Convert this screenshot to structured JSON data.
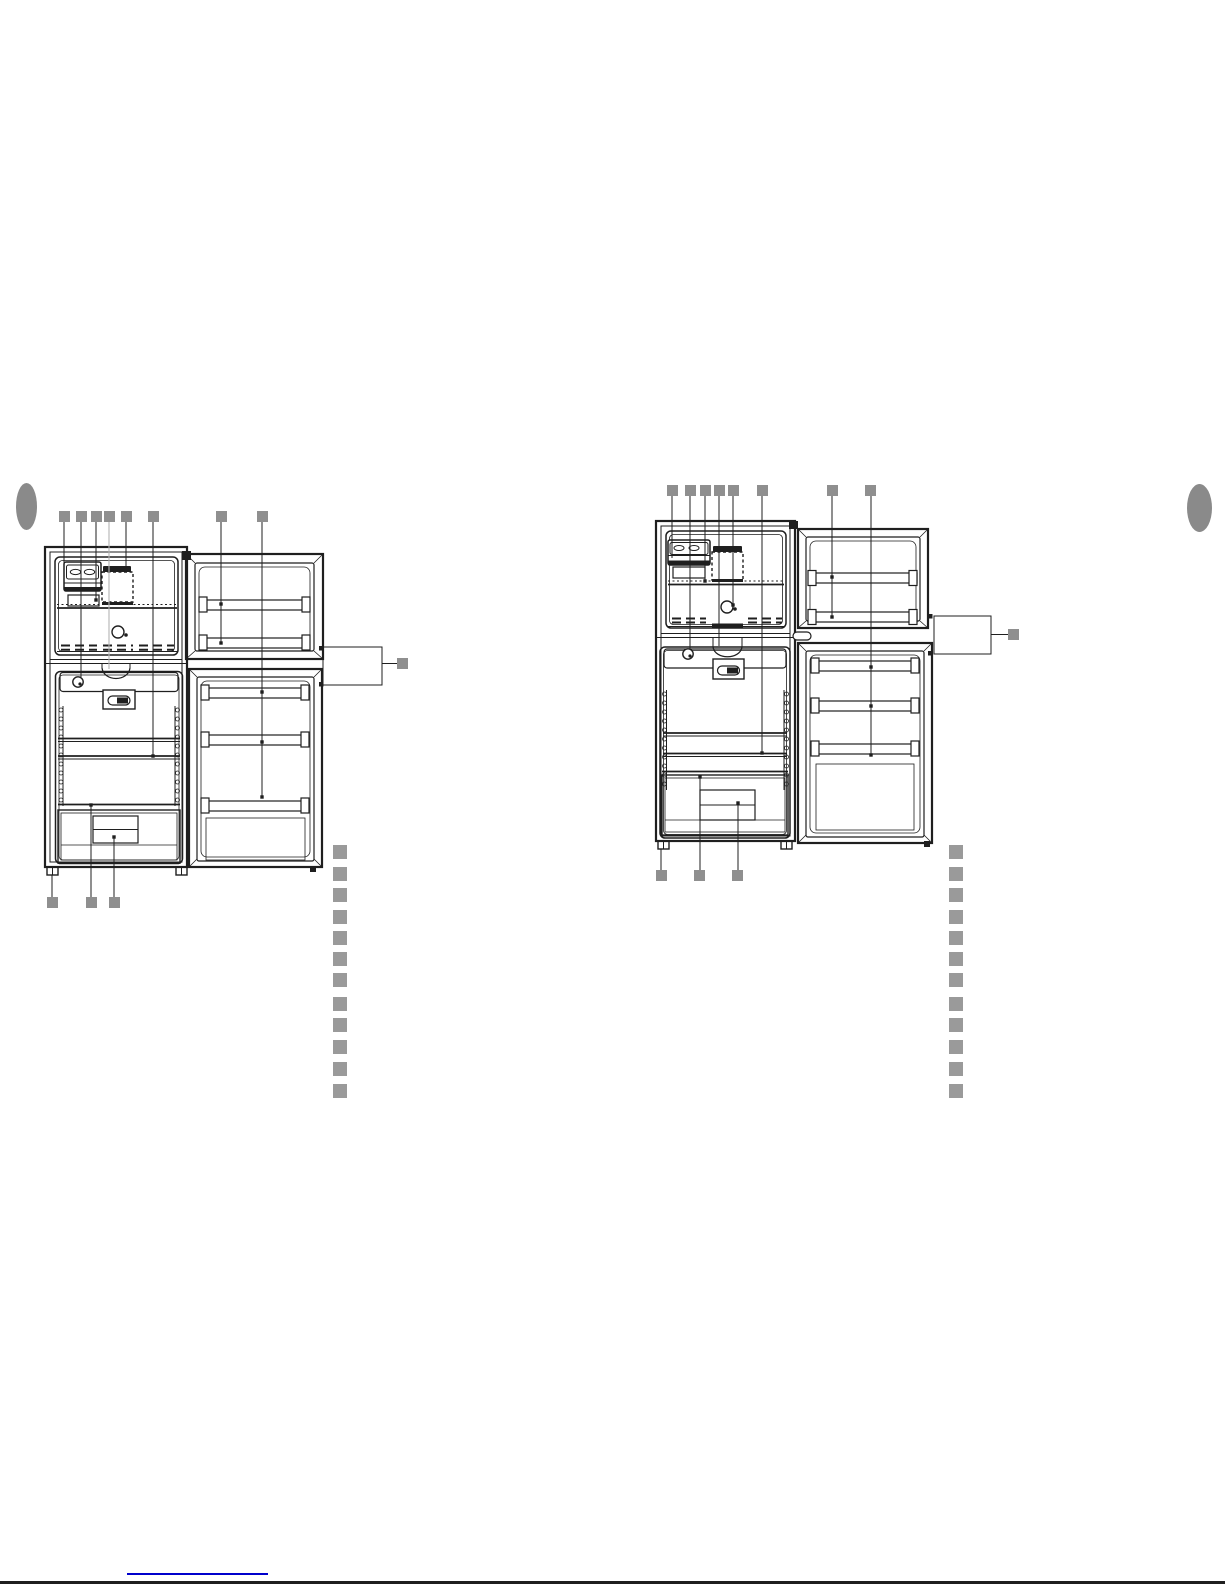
{
  "page": {
    "width": 1225,
    "height": 1585,
    "background": "#ffffff",
    "line_color": "#1f1f1f",
    "light_leader_color": "#b3b3b3",
    "callout_marker_color": "#8f8f8f",
    "caption_placeholder_color": "#9a9a9a",
    "side_oval_color": "#8a8a8a",
    "footer_link_color": "#0000cc",
    "footer_rule_color": "#000000"
  },
  "figures": [
    {
      "name": "refrigerator-diagram-left",
      "callout_size": 11,
      "top_callouts": [
        {
          "x": 59,
          "y": 511
        },
        {
          "x": 76,
          "y": 511
        },
        {
          "x": 91,
          "y": 511
        },
        {
          "x": 104,
          "y": 511
        },
        {
          "x": 121,
          "y": 511
        },
        {
          "x": 148,
          "y": 511
        },
        {
          "x": 216,
          "y": 511
        },
        {
          "x": 257,
          "y": 511
        }
      ],
      "bottom_callouts": [
        {
          "x": 47,
          "y": 897
        },
        {
          "x": 86,
          "y": 897
        },
        {
          "x": 109,
          "y": 897
        }
      ],
      "side_callout": {
        "x": 397,
        "y": 658
      }
    },
    {
      "name": "refrigerator-diagram-right",
      "callout_size": 11,
      "top_callouts": [
        {
          "x": 667,
          "y": 485
        },
        {
          "x": 685,
          "y": 485
        },
        {
          "x": 700,
          "y": 485
        },
        {
          "x": 714,
          "y": 485
        },
        {
          "x": 728,
          "y": 485
        },
        {
          "x": 757,
          "y": 485
        },
        {
          "x": 827,
          "y": 485
        },
        {
          "x": 865,
          "y": 485
        }
      ],
      "bottom_callouts": [
        {
          "x": 656,
          "y": 870
        },
        {
          "x": 694,
          "y": 870
        },
        {
          "x": 732,
          "y": 870
        }
      ],
      "side_callout": {
        "x": 1008,
        "y": 629
      }
    }
  ],
  "caption_placeholders": {
    "square_size": 14,
    "left_column": {
      "x": 333,
      "ys": [
        845,
        867,
        888,
        910,
        931,
        952,
        973,
        997,
        1018,
        1040,
        1062,
        1084
      ]
    },
    "right_column": {
      "x": 949,
      "ys": [
        845,
        867,
        888,
        910,
        931,
        952,
        973,
        997,
        1018,
        1040,
        1062,
        1084
      ]
    }
  },
  "page_side_ovals": {
    "left": {
      "x": 16,
      "y": 483,
      "w": 21,
      "h": 47
    },
    "right": {
      "x": 1187,
      "y": 484,
      "w": 25,
      "h": 48
    }
  },
  "footer": {
    "link_underline": {
      "x": 127,
      "y": 1573,
      "w": 141,
      "h": 2
    },
    "bottom_rule": {
      "x": 0,
      "y": 1581,
      "w": 1225,
      "h": 3
    }
  }
}
